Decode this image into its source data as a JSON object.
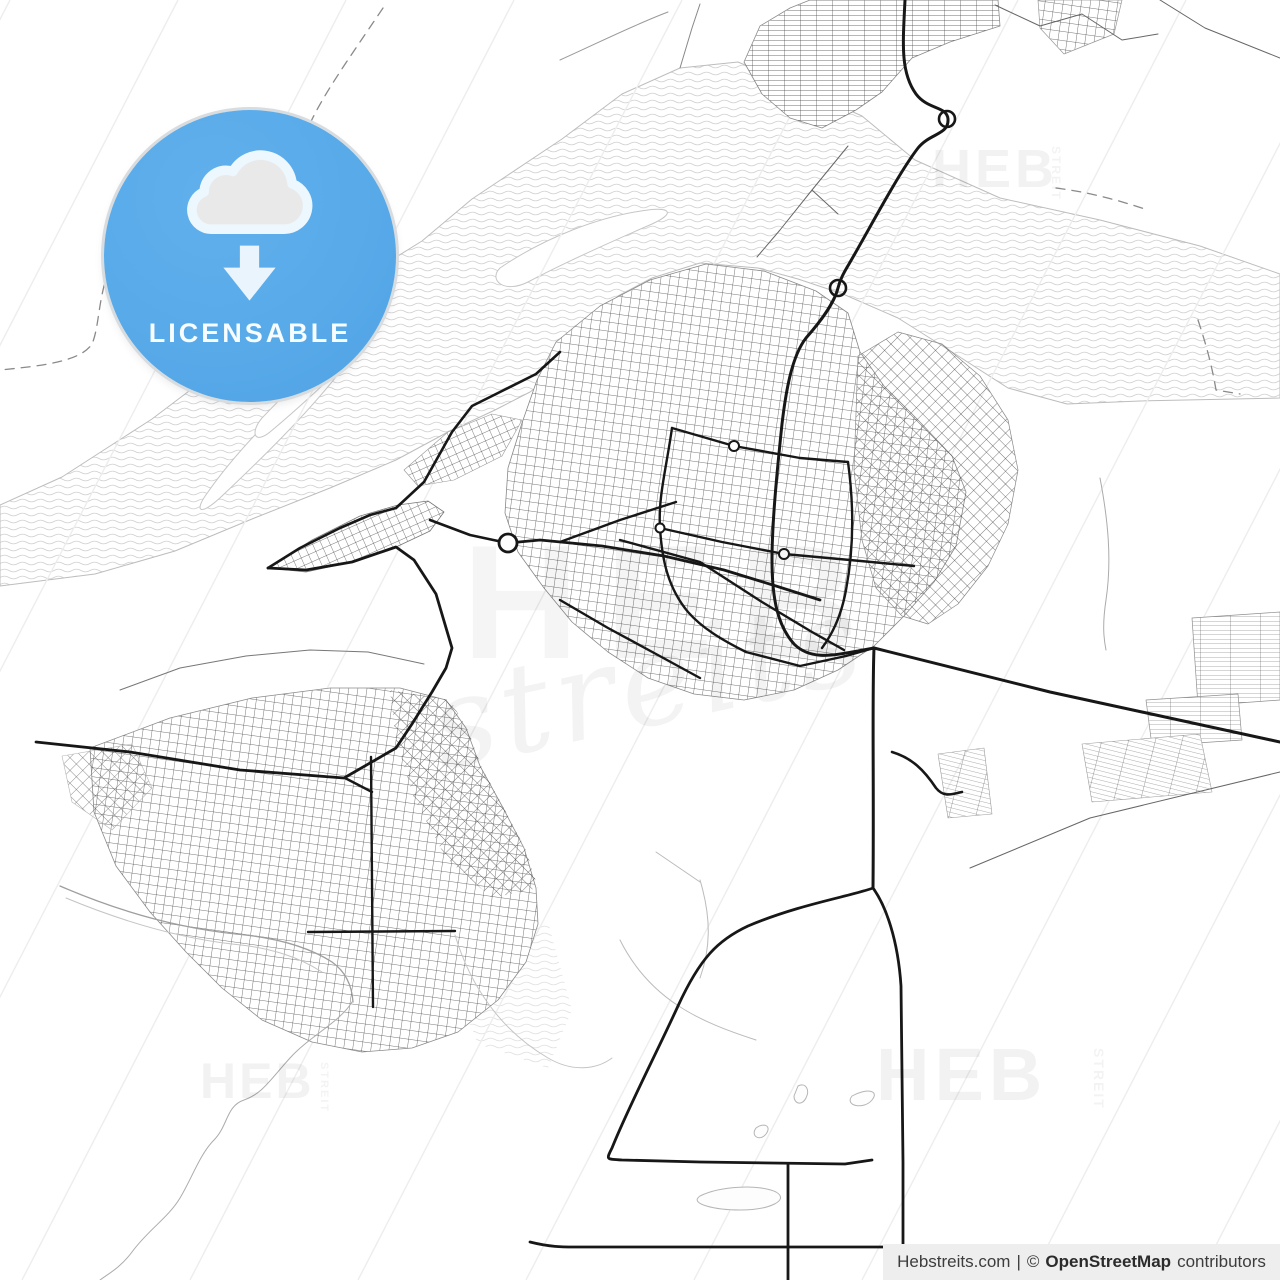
{
  "page": {
    "width": 1280,
    "height": 1280
  },
  "colors": {
    "badge_blue": "#57a9e8",
    "attribution_bg": "#eeeeee",
    "watermark": "rgba(20,20,20,0.055)",
    "water_line": "#cfcfcf",
    "shoreline": "#bdbdbd",
    "road_bold": "#171717",
    "road_thin": "#666666",
    "hatch_line": "#ededed"
  },
  "badge": {
    "label": "LICENSABLE"
  },
  "watermark": {
    "heb": "HEB",
    "streit": "STREIT",
    "script": "streits"
  },
  "attribution": {
    "site": "Hebstreits.com",
    "sep": "|",
    "copy": "©",
    "osm": "OpenStreetMap",
    "contributors": "contributors"
  },
  "map": {
    "hatch": {
      "x0": -650,
      "x1": 1500,
      "step": 168,
      "run": 660,
      "color": "#ededed",
      "width": 1.4
    },
    "paths": [
      {
        "g": "water",
        "d": "M680,68 L738,62 L795,86 L862,116 L915,160 L1000,198 L1100,220 L1200,246 L1280,274 L1280,398 L1140,401 L1067,404 L1008,388 L952,352 L898,318 L843,294 L798,279 L758,268 L700,263 L652,278 L618,296 L588,331 L558,371 L530,392 L495,410 L448,432 L396,460 L330,488 L252,519 L175,551 L95,574 L0,586 L0,505 L62,477 L152,419 L242,351 L332,297 L422,241 L472,199 L562,139 L622,94 Z",
        "f": "url(#pat-waves)",
        "s": "#bdbdbd",
        "w": 1
      },
      {
        "g": "water",
        "d": "M208,492 C240,446 292,396 332,360 C354,340 366,334 346,364 C310,412 258,462 222,496 C200,517 193,512 208,492 Z",
        "f": "#ffffff",
        "s": "#c6c6c6",
        "w": 1
      },
      {
        "g": "water",
        "d": "M262,418 C294,384 332,350 358,332 C374,322 378,328 364,344 C332,378 294,412 270,432 C254,445 250,432 262,418 Z",
        "f": "#ffffff",
        "s": "#c6c6c6",
        "w": 1
      },
      {
        "g": "water",
        "d": "M500,268 C544,238 600,216 648,210 C672,207 674,214 652,224 C606,244 558,266 528,282 C504,294 488,280 500,268 Z",
        "f": "#ffffff",
        "s": "#c6c6c6",
        "w": 1
      },
      {
        "g": "water",
        "d": "M452,938 L548,922 L572,1010 L548,1068 L478,1044 L455,985 Z",
        "f": "url(#pat-waves)",
        "o": 0.65
      },
      {
        "g": "districts",
        "d": "M620,430 C660,408 700,418 722,450 C732,480 700,502 660,496 C620,490 598,456 620,430 Z",
        "f": "#f2f2f2",
        "o": 0.7
      },
      {
        "g": "districts",
        "d": "M742,600 C772,588 800,596 808,618 C814,640 792,654 764,650 C738,646 722,612 742,600 Z",
        "f": "#f2f2f2",
        "o": 0.7
      },
      {
        "g": "districts",
        "d": "M760,26 L790,8 L810,0 L998,0 L1000,26 L950,42 L912,58 L882,92 L856,110 L822,128 L790,118 L762,94 L744,62 Z",
        "f": "#ffffff"
      },
      {
        "g": "districts",
        "d": "M760,26 L790,8 L810,0 L998,0 L1000,26 L950,42 L912,58 L882,92 L856,110 L822,128 L790,118 L762,94 L744,62 Z",
        "f": "url(#pat-fine)",
        "s": "#8a8a8a",
        "w": 0.8
      },
      {
        "g": "districts",
        "d": "M1038,0 L1122,0 L1114,34 L1064,54 L1040,28 Z",
        "f": "#ffffff"
      },
      {
        "g": "districts",
        "d": "M1038,0 L1122,0 L1114,34 L1064,54 L1040,28 Z",
        "f": "url(#pat-ortho)",
        "s": "#999999",
        "w": 0.7
      },
      {
        "g": "districts",
        "d": "M556,342 L600,306 L650,280 L706,264 L764,271 L816,291 L848,313 L860,352 L884,386 L918,420 L952,456 L966,492 L956,546 L934,582 L904,616 L874,646 L838,670 L794,690 L744,700 L694,694 L648,678 L608,652 L572,622 L544,588 L518,552 L505,513 L508,468 L522,423 L537,380 Z",
        "f": "#ffffff"
      },
      {
        "g": "districts",
        "d": "M556,342 L600,306 L650,280 L706,264 L764,271 L816,291 L848,313 L860,352 L884,386 L918,420 L952,456 L966,492 L956,546 L934,582 L904,616 L874,646 L838,670 L794,690 L744,700 L694,694 L648,678 L608,652 L572,622 L544,588 L518,552 L505,513 L508,468 L522,423 L537,380 Z",
        "f": "url(#pat-ortho)",
        "s": "#888888",
        "w": 0.8
      },
      {
        "g": "districts",
        "d": "M858,356 L898,332 L942,344 L980,376 L1008,420 L1018,470 L1008,524 L988,566 L958,604 L928,624 L902,616 L876,588 L862,540 L854,470 Z",
        "f": "url(#pat-diag)",
        "s": "#8a8a8a",
        "w": 0.7
      },
      {
        "g": "districts",
        "d": "M268,568 L312,540 L360,516 L398,505 L428,501 L444,512 L430,531 L396,547 L352,562 L306,572 Z",
        "f": "#ffffff"
      },
      {
        "g": "districts",
        "d": "M268,568 L312,540 L360,516 L398,505 L428,501 L444,512 L430,531 L396,547 L352,562 L306,572 Z",
        "f": "url(#pat-diag2)",
        "s": "#777777",
        "w": 0.8
      },
      {
        "g": "districts",
        "d": "M404,470 L448,432 L492,414 L522,420 L502,456 L454,480 L418,486 Z",
        "f": "#ffffff"
      },
      {
        "g": "districts",
        "d": "M404,470 L448,432 L492,414 L522,420 L502,456 L454,480 L418,486 Z",
        "f": "url(#pat-diag2)",
        "s": "#999999",
        "w": 0.6
      },
      {
        "g": "districts",
        "d": "M90,748 L170,718 L252,698 L330,688 L400,688 L446,700 L466,728 L480,766 L502,806 L524,848 L536,888 L538,924 L526,962 L498,1000 L458,1032 L412,1048 L362,1052 L312,1042 L262,1020 L222,988 L186,952 L150,912 L116,866 L94,812 Z",
        "f": "#ffffff"
      },
      {
        "g": "districts",
        "d": "M90,748 L170,718 L252,698 L330,688 L400,688 L446,700 L466,728 L480,766 L502,806 L524,848 L536,888 L538,924 L526,962 L498,1000 L458,1032 L412,1048 L362,1052 L312,1042 L262,1020 L222,988 L186,952 L150,912 L116,866 L94,812 Z",
        "f": "url(#pat-ortho)",
        "s": "#8a8a8a",
        "w": 0.8
      },
      {
        "g": "districts",
        "d": "M390,690 L450,700 L468,730 L482,768 L504,808 L526,850 L538,888 L492,898 L446,858 L414,798 L396,740 Z",
        "f": "url(#pat-diag)"
      },
      {
        "g": "districts",
        "d": "M62,756 L132,744 L152,788 L112,830 L72,802 Z",
        "f": "url(#pat-diag)",
        "s": "#aaaaaa",
        "w": 0.6,
        "o": 0.85
      },
      {
        "g": "districts",
        "d": "M1192,618 L1280,612 L1280,700 L1198,706 Z",
        "f": "#ffffff"
      },
      {
        "g": "districts",
        "d": "M1192,618 L1280,612 L1280,700 L1198,706 Z",
        "f": "url(#pat-comb)",
        "s": "#8f8f8f",
        "w": 0.7
      },
      {
        "g": "districts",
        "d": "M1146,700 L1238,694 L1242,740 L1152,746 Z",
        "f": "#ffffff"
      },
      {
        "g": "districts",
        "d": "M1146,700 L1238,694 L1242,740 L1152,746 Z",
        "f": "url(#pat-comb)",
        "s": "#8f8f8f",
        "w": 0.7
      },
      {
        "g": "districts",
        "d": "M1082,744 L1200,734 L1212,792 L1092,802 Z",
        "f": "#ffffff"
      },
      {
        "g": "districts",
        "d": "M1082,744 L1200,734 L1212,792 L1092,802 Z",
        "f": "url(#pat-comb2)",
        "s": "#9a9a9a",
        "w": 0.6
      },
      {
        "g": "districts",
        "d": "M938,754 L984,748 L992,814 L948,818 Z",
        "f": "url(#pat-comb2)",
        "s": "#9a9a9a",
        "w": 0.6
      },
      {
        "g": "streams",
        "d": "M1100,478 C1108,520 1112,560 1106,600 C1102,626 1104,640 1106,650",
        "s": "#ababab",
        "w": 1
      },
      {
        "g": "streams",
        "d": "M352,1002 C340,1022 310,1036 290,1058 C270,1080 262,1094 244,1100 C226,1106 228,1126 214,1140 C200,1154 192,1178 180,1198 C168,1218 148,1230 132,1252 C120,1268 108,1274 100,1280",
        "s": "#ababab",
        "w": 1
      },
      {
        "g": "streams",
        "d": "M60,886 C120,912 180,928 236,934 C280,938 310,948 332,962 C346,972 352,986 353,1002",
        "s": "#9e9e9e",
        "w": 1.3
      },
      {
        "g": "streams",
        "d": "M66,898 C124,922 180,938 232,944 C274,948 300,958 322,972",
        "s": "#c4c4c4",
        "w": 1
      },
      {
        "g": "streams",
        "d": "M455,935 C470,985 500,1030 548,1058 C572,1072 596,1070 612,1058",
        "s": "#c4c4c4",
        "w": 1
      },
      {
        "g": "streams",
        "d": "M700,880 C712,920 710,950 700,978",
        "s": "#bbbbbb",
        "w": 1
      },
      {
        "g": "streams",
        "d": "M620,940 C650,1000 700,1022 756,1040",
        "s": "#bbbbbb",
        "w": 1
      },
      {
        "g": "streams",
        "d": "M656,852 L700,882",
        "s": "#bbbbbb",
        "w": 1
      },
      {
        "g": "streams",
        "d": "M798,1086 C806,1082 810,1090 806,1098 C802,1106 794,1104 794,1096 Z",
        "f": "#fdfdfd",
        "s": "#b5b5b5",
        "w": 1
      },
      {
        "g": "streams",
        "d": "M852,1096 C866,1088 880,1090 872,1100 C864,1110 844,1106 852,1096 Z",
        "f": "#fdfdfd",
        "s": "#b5b5b5",
        "w": 1
      },
      {
        "g": "streams",
        "d": "M756,1128 C764,1122 772,1126 766,1134 C760,1142 750,1136 756,1128 Z",
        "f": "#fdfdfd",
        "s": "#b5b5b5",
        "w": 1
      },
      {
        "g": "streams",
        "d": "M700,1196 C720,1186 760,1184 776,1192 C790,1200 770,1210 740,1210 C716,1210 688,1204 700,1196 Z",
        "f": "#fdfdfd",
        "s": "#b5b5b5",
        "w": 1
      },
      {
        "g": "thin",
        "d": "M995,5 L1040,26 L1082,14 L1122,40 L1158,34",
        "s": "#666666",
        "w": 1
      },
      {
        "g": "thin",
        "d": "M1160,0 L1205,28 L1280,58",
        "s": "#666666",
        "w": 1
      },
      {
        "g": "thin",
        "d": "M970,868 L1090,818 L1280,772",
        "s": "#666666",
        "w": 1
      },
      {
        "g": "thin",
        "d": "M680,68 L692,28 L700,4",
        "s": "#888888",
        "w": 1
      },
      {
        "g": "thin",
        "d": "M848,146 L812,190 L780,230 L757,257",
        "s": "#666666",
        "w": 1
      },
      {
        "g": "thin",
        "d": "M812,190 L838,214",
        "s": "#666666",
        "w": 1
      },
      {
        "g": "thin",
        "d": "M120,690 L180,668 L246,656 L310,650 L368,652 L424,664",
        "s": "#777777",
        "w": 1
      },
      {
        "g": "thin",
        "d": "M560,60 C600,42 636,24 668,12",
        "s": "#999999",
        "w": 1
      },
      {
        "g": "bold",
        "d": "M905,0 C903,42 900,72 916,94 C928,110 947,106 948,119 C949,135 930,133 918,148 C898,174 870,228 849,264 C843,274 840,280 838,288 C834,304 820,322 806,338 C792,356 786,390 782,424 C778,462 772,520 772,560 C772,600 778,626 794,644 C812,662 838,654 858,651 L874,648",
        "s": "#171717",
        "w": 3
      },
      {
        "g": "bold",
        "d": "M874,648 L1050,692 L1280,742",
        "s": "#171717",
        "w": 3
      },
      {
        "g": "bold",
        "d": "M874,648 C872,700 874,780 873,888",
        "s": "#171717",
        "w": 3
      },
      {
        "g": "bold",
        "d": "M873,888 C886,906 898,940 901,986 L903,1162 L903,1280",
        "s": "#171717",
        "w": 2.8
      },
      {
        "g": "bold",
        "d": "M873,888 C852,896 800,904 748,926 C718,940 700,958 678,1006 C656,1054 628,1108 612,1148 C606,1160 606,1159 622,1160 L700,1162 L845,1164 L872,1160",
        "s": "#171717",
        "w": 2.8
      },
      {
        "g": "bold",
        "d": "M530,1242 C550,1247 562,1247 574,1247 L905,1247",
        "s": "#171717",
        "w": 2.8
      },
      {
        "g": "bold",
        "d": "M788,1164 L788,1280",
        "s": "#171717",
        "w": 2.8
      },
      {
        "g": "bold",
        "d": "M268,568 L306,570 L352,562 L396,547 L414,560 L436,594 L452,648 L446,668 L432,692 L412,724 L396,748 L344,778 L240,770 L130,752 L36,742",
        "s": "#171717",
        "w": 2.8
      },
      {
        "g": "bold",
        "d": "M508,543 L540,540 L602,546 L664,556 L724,570 L776,586 L820,600",
        "s": "#171717",
        "w": 2.8
      },
      {
        "g": "bold",
        "d": "M396,508 L424,482 L452,432 L472,406 L504,390 L536,374 L560,352",
        "s": "#171717",
        "w": 2.6
      },
      {
        "g": "bold",
        "d": "M268,568 L300,548 L340,528 L370,515 L396,508",
        "s": "#171717",
        "w": 2.6
      },
      {
        "g": "bold",
        "d": "M430,520 L470,535 L498,541",
        "s": "#171717",
        "w": 2.6
      },
      {
        "g": "bold",
        "d": "M672,428 C666,470 658,498 660,528 C662,560 668,588 688,612 C702,628 722,640 746,652",
        "s": "#171717",
        "w": 2.4
      },
      {
        "g": "bold",
        "d": "M672,428 L734,446 L800,458 L848,462",
        "s": "#171717",
        "w": 2.4
      },
      {
        "g": "bold",
        "d": "M660,528 L722,542 L784,554 L850,560 L914,566",
        "s": "#171717",
        "w": 2.4
      },
      {
        "g": "bold",
        "d": "M848,462 C854,506 854,548 846,590 C842,612 834,632 822,648",
        "s": "#171717",
        "w": 2.4
      },
      {
        "g": "bold",
        "d": "M746,652 L800,666 L846,656 L874,648",
        "s": "#171717",
        "w": 2.4
      },
      {
        "g": "bold",
        "d": "M560,542 L620,520 L676,502",
        "s": "#171717",
        "w": 2.4
      },
      {
        "g": "bold",
        "d": "M620,540 L700,562 L762,602 L812,632 L844,650",
        "s": "#171717",
        "w": 2.4
      },
      {
        "g": "bold",
        "d": "M560,600 L608,628 L656,654 L700,678",
        "s": "#171717",
        "w": 2.4
      },
      {
        "g": "bold",
        "d": "M371,757 L373,1007",
        "s": "#171717",
        "w": 2.4
      },
      {
        "g": "bold",
        "d": "M308,932 L455,931",
        "s": "#171717",
        "w": 2.4
      },
      {
        "g": "bold",
        "d": "M345,778 L372,792",
        "s": "#171717",
        "w": 2.4
      },
      {
        "g": "bold",
        "d": "M892,752 C912,758 924,770 936,788 C944,798 952,794 962,792",
        "s": "#171717",
        "w": 2.6
      },
      {
        "g": "dashed",
        "d": "M383,8 C348,60 322,96 308,128 C294,160 282,182 262,198 C240,214 196,222 162,230 C130,238 112,256 104,286 C98,310 98,330 92,344 C80,362 40,366 0,370",
        "s": "#8a8a8a",
        "w": 1.3,
        "da": "9 7"
      },
      {
        "g": "dashed",
        "d": "M1056,188 C1088,192 1118,200 1148,210",
        "s": "#8a8a8a",
        "w": 1.3,
        "da": "9 7"
      },
      {
        "g": "dashed",
        "d": "M1198,320 C1206,344 1212,366 1216,390 L1240,394",
        "s": "#8a8a8a",
        "w": 1.3,
        "da": "9 7"
      }
    ],
    "circles": [
      {
        "cx": 947,
        "cy": 119,
        "r": 8,
        "s": "#171717",
        "w": 2.6,
        "f": "none"
      },
      {
        "cx": 838,
        "cy": 288,
        "r": 8,
        "s": "#171717",
        "w": 2.6,
        "f": "none"
      },
      {
        "cx": 508,
        "cy": 543,
        "r": 9,
        "s": "#171717",
        "w": 2.8,
        "f": "#ffffff"
      },
      {
        "cx": 734,
        "cy": 446,
        "r": 5,
        "s": "#171717",
        "w": 2,
        "f": "#ffffff"
      },
      {
        "cx": 784,
        "cy": 554,
        "r": 5,
        "s": "#171717",
        "w": 2,
        "f": "#ffffff"
      },
      {
        "cx": 660,
        "cy": 528,
        "r": 4.5,
        "s": "#171717",
        "w": 2,
        "f": "#ffffff"
      }
    ]
  }
}
